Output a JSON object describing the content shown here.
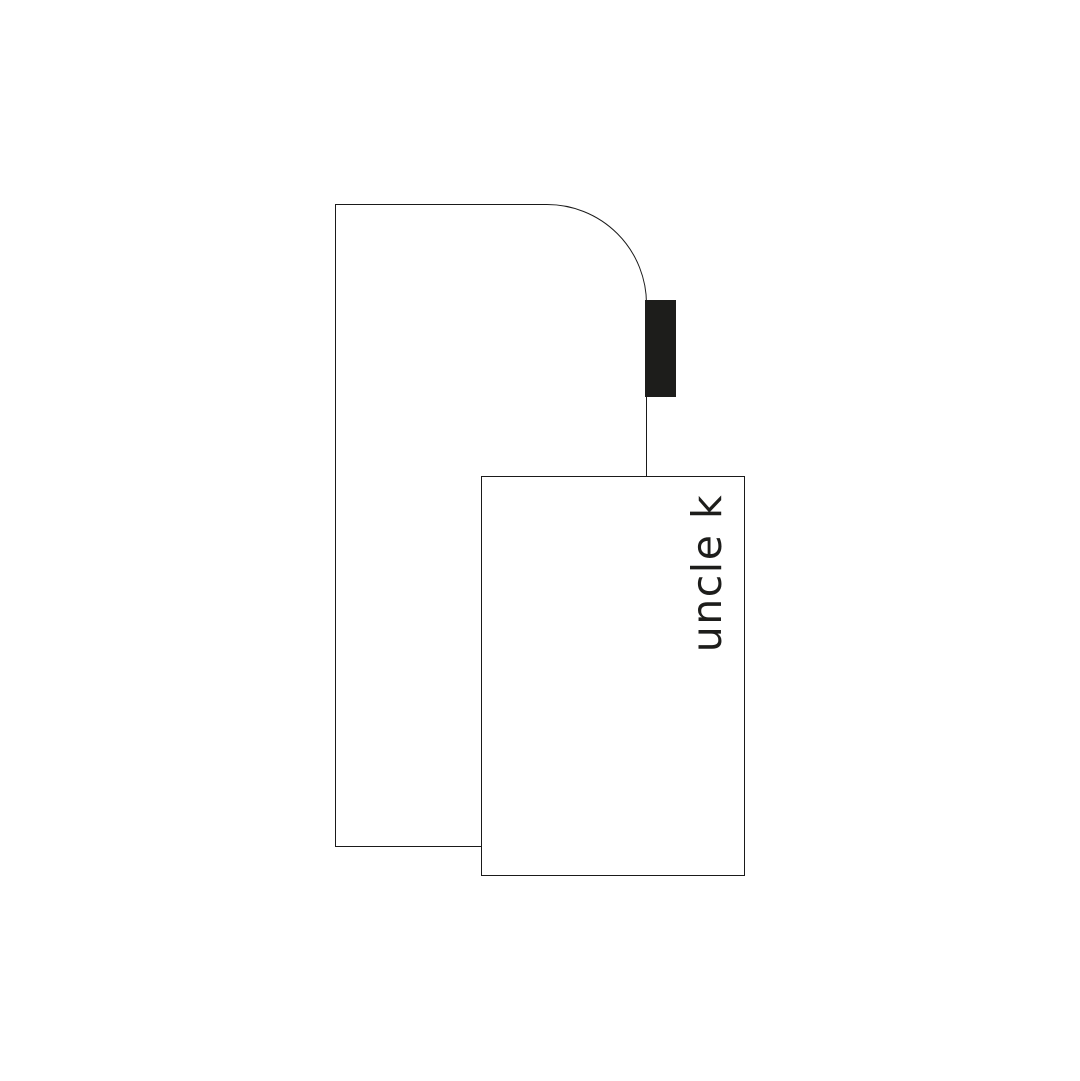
{
  "illustration": {
    "description": "Minimalist line illustration: tall arch-topped outlined shape with a solid black tab on its right edge, overlapped by an outlined card bearing vertical brand text",
    "brand": {
      "label": "uncle k"
    },
    "colors": {
      "ink": "#1d1d1b",
      "stroke": "#1a1a1a",
      "surface": "#ffffff"
    },
    "shapes": {
      "arch_shape": "tall rectangle with rounded top-right corner, white fill, thin dark outline",
      "black_tab": "small solid near-black rectangle on right edge of arch shape",
      "card": "upright rectangle, white fill, thin dark outline, overlapping lower right of arch shape"
    }
  }
}
